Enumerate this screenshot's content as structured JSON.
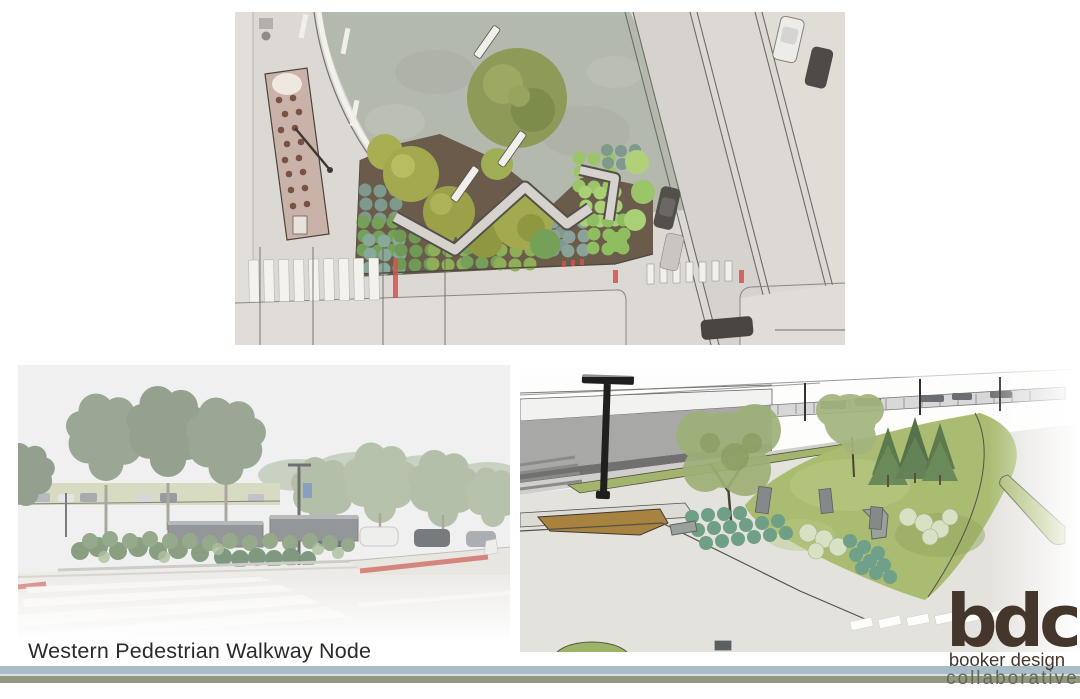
{
  "slide": {
    "title": "Western Pedestrian Walkway Node"
  },
  "logo": {
    "acronym": "bdc",
    "name_line": "booker design",
    "sub_line": "collaborative"
  },
  "colors": {
    "footer_bar_top": "#a9bdc9",
    "footer_bar_bottom": "#92987d",
    "logo_brown": "#44362a",
    "logo_sub_gray": "#62675a",
    "title_text": "#2e2b27"
  },
  "figures": {
    "plan": {
      "name": "site-plan-aerial-view"
    },
    "photo": {
      "name": "streetscape-photo-rendering"
    },
    "model": {
      "name": "model-3d-rendering"
    }
  }
}
